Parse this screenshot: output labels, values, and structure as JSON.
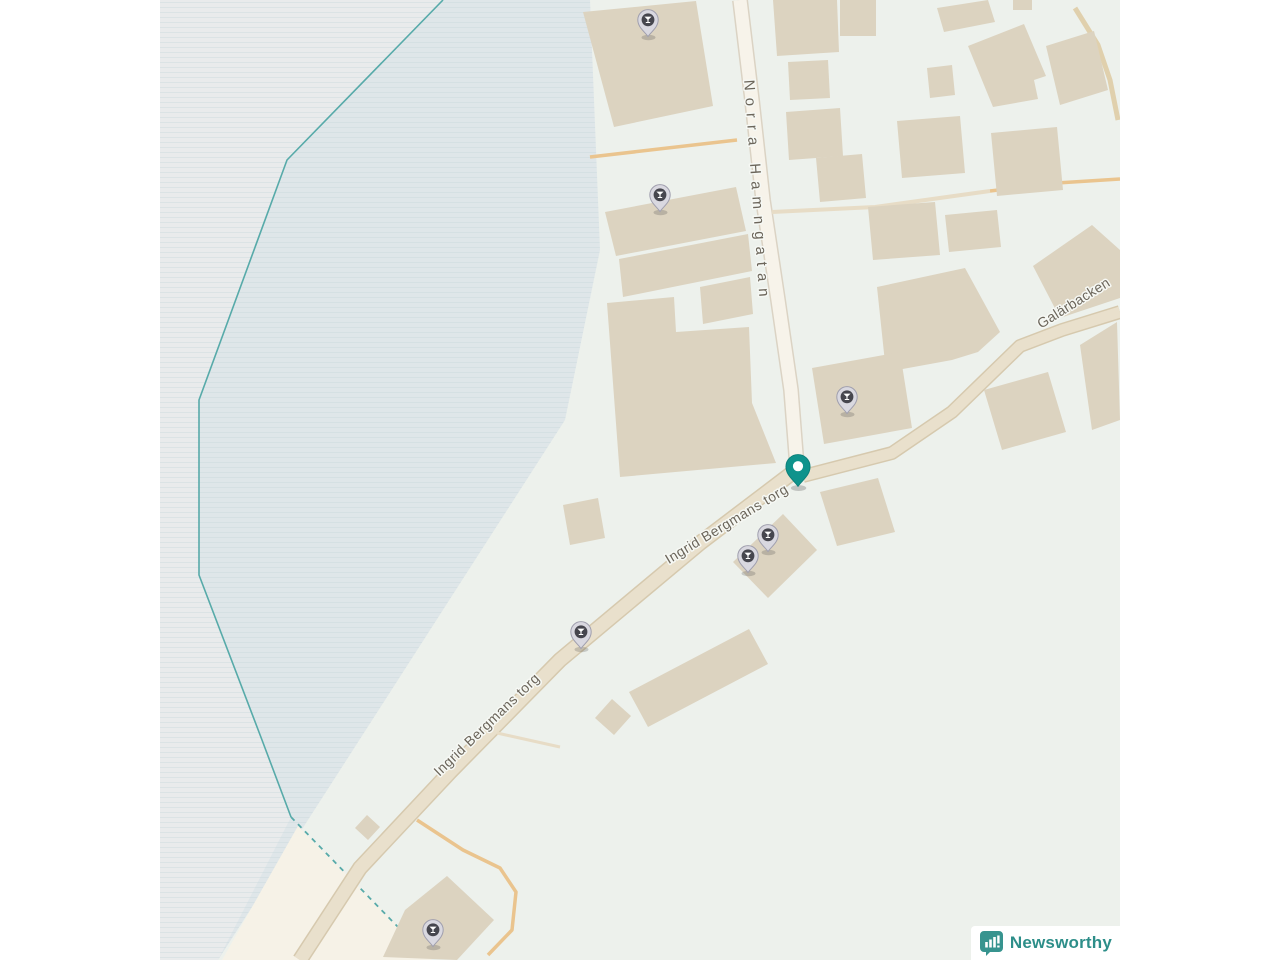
{
  "map": {
    "width": 960,
    "height": 960,
    "colors": {
      "land": "#edf1ec",
      "water": "#dfe6e9",
      "water_outer": "#e9ebec",
      "water_texture_line": "#c9d8dc",
      "coast_line": "#57aaa9",
      "sand": "#f6f2e7",
      "building": "#dcd3c0",
      "road_major_fill": "#f7f3ea",
      "road_major_casing": "#dbd3c4",
      "road_minor_fill": "#e9e0cc",
      "road_minor_casing": "#d6c9ae",
      "path_orange": "#eac48e",
      "path_tan": "#e7dcc6",
      "path_light": "#e0d0ad",
      "label_text": "#6b655a",
      "marker_body": "#d9d8e0",
      "marker_stroke": "#a09fae",
      "marker_inner": "#46464e",
      "highlight_pin": "#0f938c",
      "highlight_pin_stroke": "#0b7f79"
    },
    "water_area": {
      "base": "0,0 430,0 440,250 405,420 58,960 0,960",
      "outer_overlay": "0,0 283,0 127,160 39,400 39,575 102,740 131,817 58,960 0,960",
      "boundary_solid": "283,0 127,160 39,400 39,575 102,740 131,817",
      "boundary_dashed": "131,817 270,960"
    },
    "sand_area": "138,826 272,960 62,960",
    "roads": [
      {
        "name": "norra-hamngatan-road",
        "points": "580,0 592,100 603,200 618,300 631,390 637,467",
        "width": 13,
        "kind": "major"
      },
      {
        "name": "ingrid-bergmans-torg-road",
        "points": "640,467 540,543 400,660 290,772 200,868 140,960",
        "width": 13,
        "kind": "minor"
      },
      {
        "name": "galarbacken-road",
        "points": "643,476 732,453 792,412 860,346 902,330 960,312",
        "width": 11,
        "kind": "minor"
      }
    ],
    "paths": [
      {
        "points": "430,157 577,140",
        "color": "path_orange",
        "width": 3.5
      },
      {
        "points": "612,212 715,207 830,191",
        "color": "path_tan",
        "width": 4
      },
      {
        "points": "830,191 897,183 960,179",
        "color": "path_orange",
        "width": 3.5
      },
      {
        "points": "915,8 938,45 950,80 958,120",
        "color": "path_light",
        "width": 5
      },
      {
        "points": "257,820 303,850 340,868 356,892 352,930 328,955",
        "color": "path_orange",
        "width": 3.5
      },
      {
        "points": "337,733 400,747",
        "color": "path_tan",
        "width": 3
      }
    ],
    "buildings": [
      "423,12 536,1 553,106 454,127",
      "613,0 677,0 679,52 617,56",
      "628,62 668,60 670,98 630,100",
      "626,112 680,108 683,156 629,160",
      "680,0 716,0 716,36 680,36",
      "777,8 828,0 835,22 784,32",
      "853,0 872,0 872,10 853,10",
      "767,68 792,65 795,95 770,98",
      "808,46 864,24 886,76 874,80 878,99 833,107",
      "886,46 934,31 948,90 900,105",
      "737,121 800,116 805,173 742,178",
      "831,133 897,127 903,190 837,196",
      "656,158 702,154 706,198 660,202",
      "708,207 775,202 780,255 713,260",
      "785,215 837,210 841,247 789,252",
      "873,266 932,225 960,250 960,298 900,318",
      "920,345 957,322 960,420 932,430",
      "445,212 576,187 586,231 456,256",
      "459,259 588,234 592,271 463,297",
      "540,287 590,277 593,314 543,324",
      "447,303 514,297 516,332 589,327 592,403 616,463 460,477",
      "717,287 805,268 840,332 818,352 792,360 726,372",
      "652,368 740,352 752,428 664,444",
      "824,390 888,372 906,432 842,450",
      "660,492 718,478 735,532 677,546",
      "403,505 438,498 445,538 410,545",
      "623,514 657,550 608,598 573,562",
      "469,692 589,629 608,664 488,727",
      "452,699 471,716 454,735 435,718",
      "207,815 220,827 208,840 195,828",
      "287,876 334,920 297,960 223,957 245,910"
    ],
    "labels": [
      {
        "text": "Norra Hamngatan",
        "x": 592,
        "y": 192,
        "rotate": 86,
        "size": 15,
        "spacing": 7
      },
      {
        "text": "Ingrid Bergmans torg",
        "x": 569,
        "y": 528,
        "rotate": -31,
        "size": 14,
        "spacing": 0.5
      },
      {
        "text": "Ingrid Bergmans torg",
        "x": 330,
        "y": 728,
        "rotate": -44,
        "size": 14,
        "spacing": 0.5
      },
      {
        "text": "Galärbacken",
        "x": 916,
        "y": 307,
        "rotate": -32,
        "size": 14,
        "spacing": 0.3
      }
    ],
    "markers": [
      {
        "x": 488,
        "y": 21,
        "type": "bar"
      },
      {
        "x": 500,
        "y": 196,
        "type": "bar"
      },
      {
        "x": 687,
        "y": 398,
        "type": "bar"
      },
      {
        "x": 608,
        "y": 536,
        "type": "bar"
      },
      {
        "x": 588,
        "y": 557,
        "type": "bar"
      },
      {
        "x": 421,
        "y": 633,
        "type": "bar"
      },
      {
        "x": 273,
        "y": 931,
        "type": "bar"
      }
    ],
    "highlight_pin": {
      "x": 638,
      "y": 468
    },
    "logo": {
      "text": "Newsworthy",
      "icon_color": "#37948f",
      "text_color": "#2d8e89"
    }
  }
}
